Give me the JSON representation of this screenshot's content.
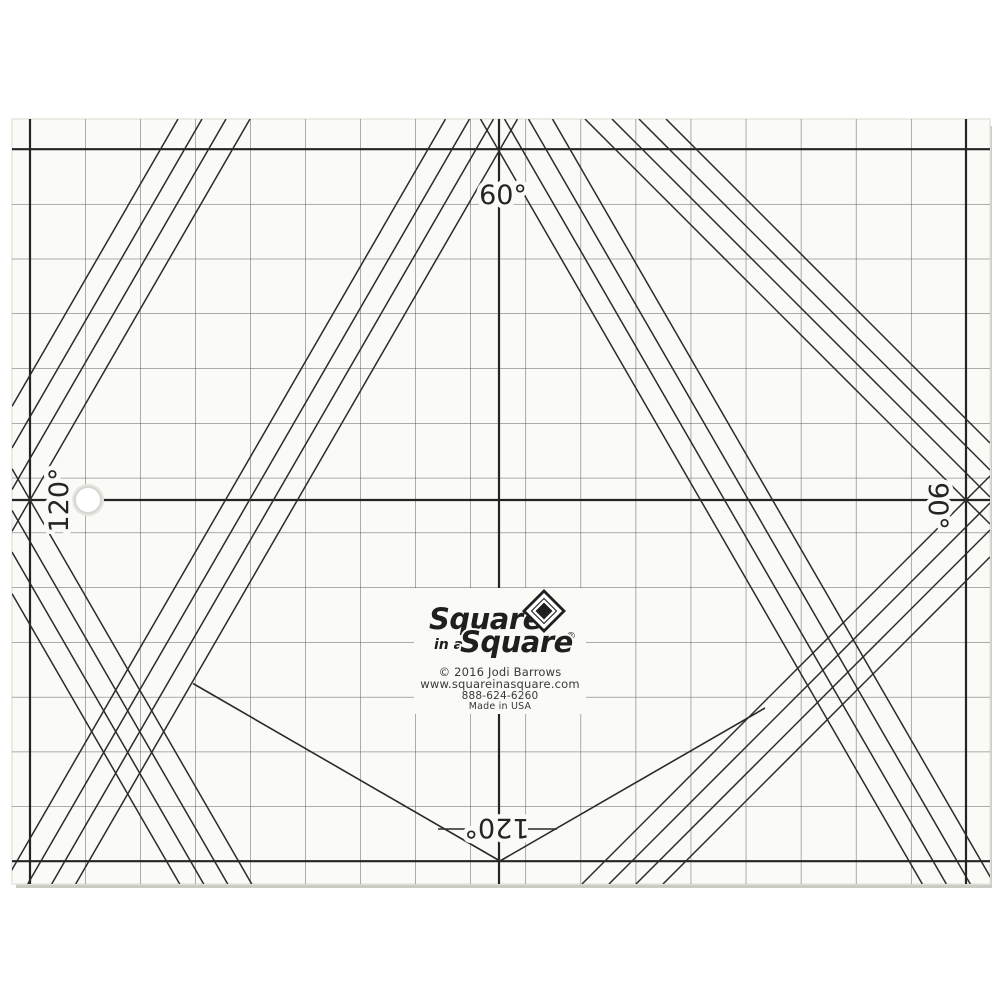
{
  "colors": {
    "page": "#ffffff",
    "paper": "#FAFAF6",
    "ink": "#242424",
    "grid": "#474747",
    "edge": "#c2c1b9"
  },
  "angle_labels": {
    "top": "60°",
    "left": "120°",
    "right": "90°",
    "bottom": "120°"
  },
  "brand": {
    "line1": "Square",
    "line2_small": "in a",
    "line2": "Square",
    "registered": "®"
  },
  "imprint": {
    "copyright": "© 2016 Jodi Barrows",
    "website": "www.squareinasquare.com",
    "phone": "888-624-6260",
    "made_in": "Made in USA"
  }
}
